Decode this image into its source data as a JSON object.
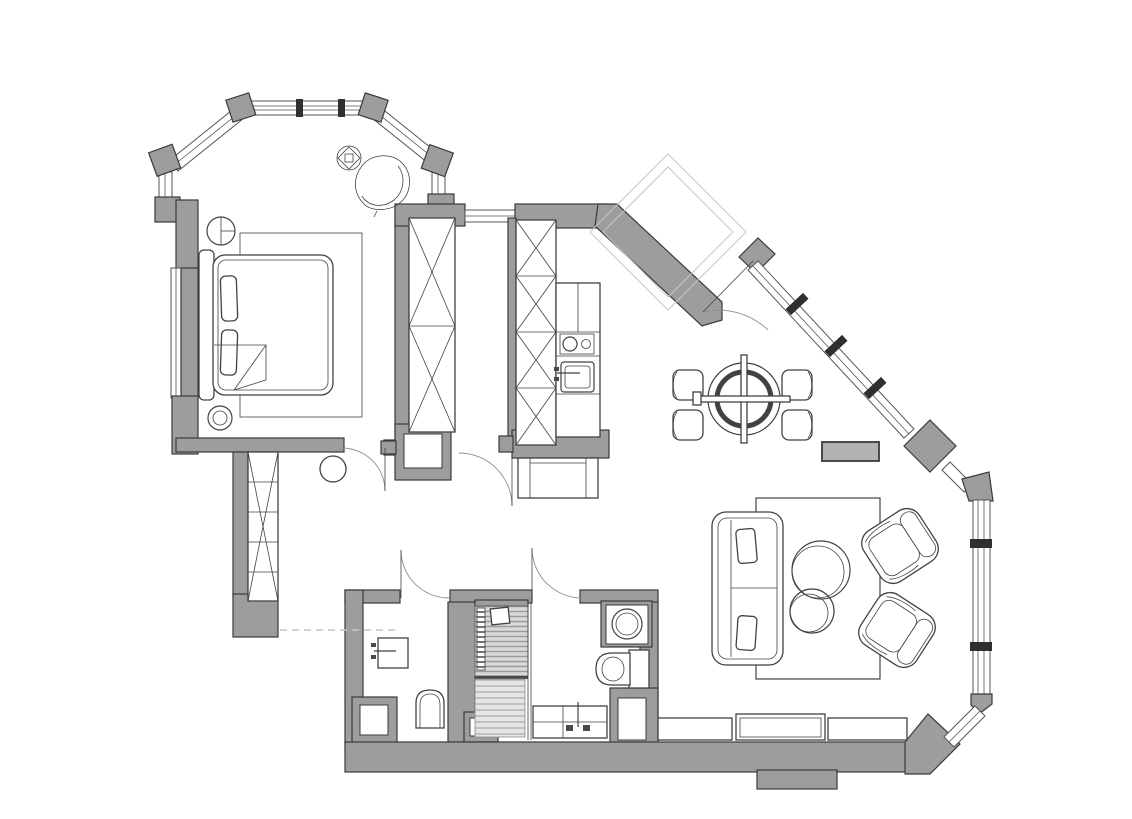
{
  "title": "apartment-floor-plan-drawing",
  "canvas": {
    "width": 1132,
    "height": 819,
    "background": "#ffffff"
  },
  "colors": {
    "bg": "#ffffff",
    "wall": "#9d9d9d",
    "outline": "#3a3a3a",
    "line": "#424242",
    "glass": "#555555",
    "mullion": "#2f2f2f",
    "arc": "#909090",
    "light": "#c5c5c5",
    "radiator": "#b2b2b2",
    "hatch_bg": "#d8d8d8",
    "hatch_line": "#9a9a9a"
  },
  "plan": {
    "rooms": [
      {
        "id": "bedroom",
        "symbols": [
          "bay-window",
          "double-bed",
          "bed-pillows",
          "blanket-fold",
          "bedroom-rug",
          "bedside-round-table",
          "round-stool",
          "ceiling-light-symbol",
          "lounge-chair"
        ]
      },
      {
        "id": "hallway",
        "symbols": [
          "hall-wardrobe-x",
          "corridor-wardrobe-x",
          "round-pouf",
          "threshold-dashed-line"
        ]
      },
      {
        "id": "kitchen",
        "symbols": [
          "tall-cabinet-column-x",
          "kitchen-counter",
          "cooktop-two-burners",
          "kitchen-sink",
          "console-bench"
        ]
      },
      {
        "id": "dining-area",
        "symbols": [
          "round-dining-table",
          "dining-chair",
          "dining-chair",
          "dining-chair",
          "dining-chair",
          "radiator-block"
        ]
      },
      {
        "id": "living-area",
        "symbols": [
          "living-rug",
          "sofa",
          "coffee-table-large",
          "coffee-table-small",
          "armchair",
          "armchair",
          "low-cabinet",
          "low-cabinet",
          "low-cabinet"
        ]
      },
      {
        "id": "wc",
        "symbols": [
          "wash-basin",
          "wall-hung-toilet"
        ]
      },
      {
        "id": "shower-room",
        "symbols": [
          "shower-hatched-floor",
          "towel-ladder",
          "shower-head-box"
        ]
      },
      {
        "id": "bathroom",
        "symbols": [
          "washing-machine",
          "toilet-with-tank",
          "vanity-counter",
          "faucet-symbol"
        ]
      }
    ],
    "openings": [
      "entry-door-arc",
      "bedroom-door-arc",
      "kitchen-door-arc",
      "wc-door-arc",
      "bathroom-door-arc"
    ],
    "windows": [
      "bay-window-band",
      "bedroom-side-window",
      "hall-transom-window",
      "entry-diagonal-window-band",
      "diamond-column",
      "right-vertical-window-band",
      "bottom-corner-window"
    ],
    "outside": [
      "entry-vestibule-outline"
    ]
  }
}
